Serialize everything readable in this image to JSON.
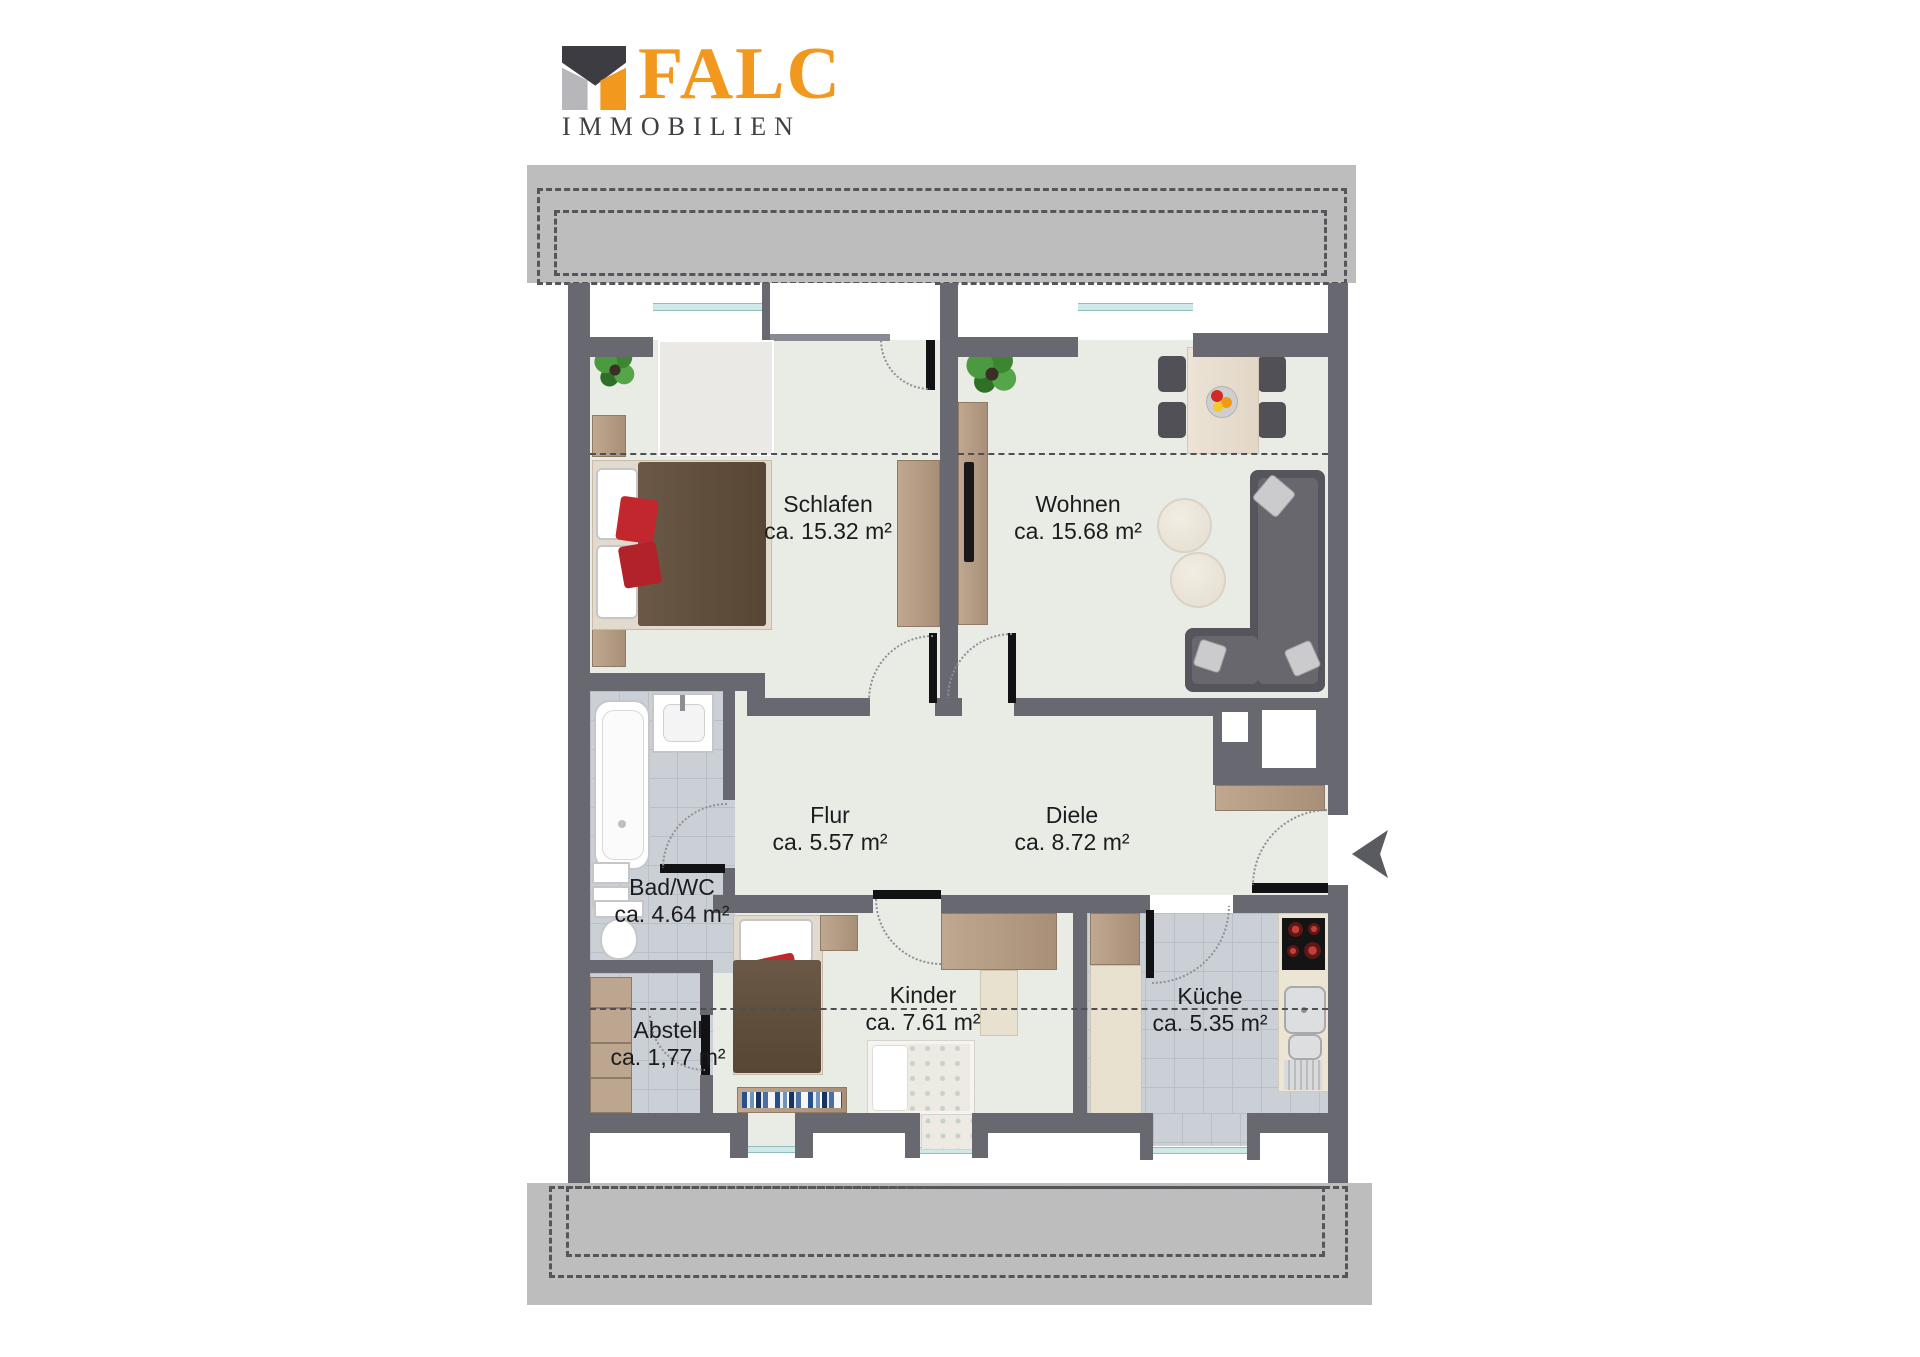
{
  "logo": {
    "brand": "FALC",
    "subtitle": "IMMOBILIEN",
    "colors": {
      "orange": "#F2981E",
      "dark": "#3C3C42",
      "gray": "#B7B7BB"
    }
  },
  "plan": {
    "rooms": [
      {
        "id": "schlafen",
        "name": "Schlafen",
        "area": "ca. 15.32 m²"
      },
      {
        "id": "wohnen",
        "name": "Wohnen",
        "area": "ca. 15.68 m²"
      },
      {
        "id": "flur",
        "name": "Flur",
        "area": "ca. 5.57 m²"
      },
      {
        "id": "diele",
        "name": "Diele",
        "area": "ca. 8.72 m²"
      },
      {
        "id": "bad",
        "name": "Bad/WC",
        "area": "ca. 4.64 m²"
      },
      {
        "id": "abstell",
        "name": "Abstell",
        "area": "ca. 1,77 m²"
      },
      {
        "id": "kinder",
        "name": "Kinder",
        "area": "ca. 7.61 m²"
      },
      {
        "id": "kueche",
        "name": "Küche",
        "area": "ca. 5.35 m²"
      }
    ],
    "colors": {
      "wall": "#686870",
      "floor": "#E9ECE4",
      "tile": "#CBD0D6",
      "wood": "#B49B85",
      "roof_band": "#BDBDBD",
      "accent_red": "#C1272D"
    },
    "icons": {
      "entrance_arrow": "left-pointing entrance arrow"
    },
    "objects": {
      "schlafen": [
        "double-bed",
        "nightstand",
        "wardrobe",
        "plant",
        "roof-window"
      ],
      "wohnen": [
        "dining-table",
        "four-chairs",
        "fruit-bowl",
        "corner-sofa",
        "round-side-tables",
        "wardrobe",
        "tv-board",
        "plant"
      ],
      "bad": [
        "bathtub",
        "wash-basin",
        "toilet",
        "shelf"
      ],
      "abstell": [
        "shelf-unit"
      ],
      "kinder": [
        "single-bed",
        "guest-bed",
        "wardrobe",
        "desk",
        "bookshelf"
      ],
      "kueche": [
        "stove",
        "double-sink",
        "kitchen-counter",
        "tall-cabinet"
      ],
      "diele": [
        "sideboard",
        "built-in-closet"
      ]
    }
  }
}
